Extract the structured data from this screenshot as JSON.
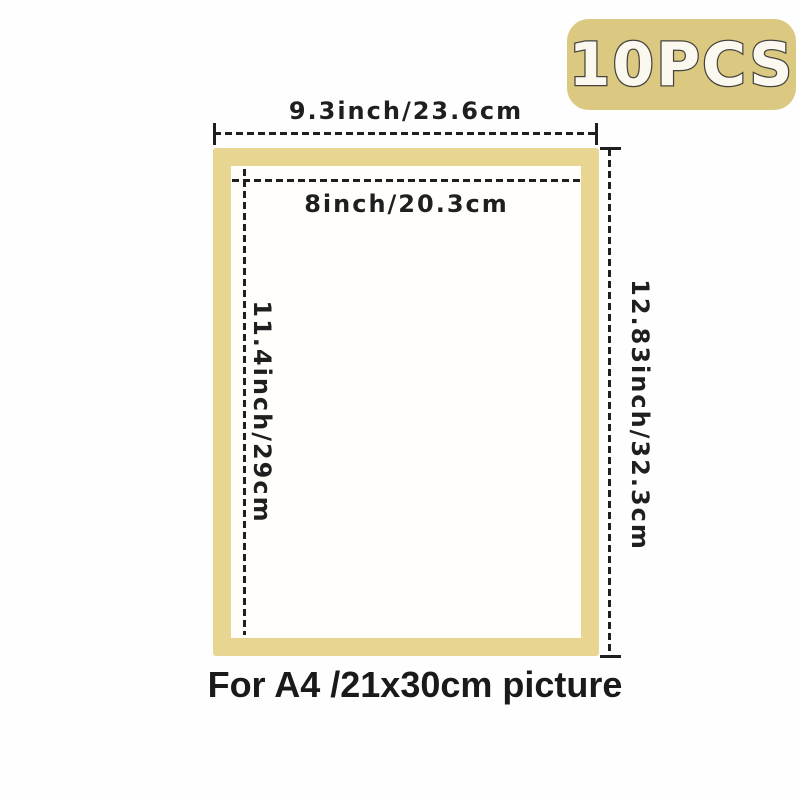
{
  "badge": {
    "label": "10PCS"
  },
  "dimensions": {
    "outer_width": {
      "label": "9.3inch/23.6cm"
    },
    "inner_width": {
      "label": "8inch/20.3cm"
    },
    "inner_height": {
      "label": "11.4inch/29cm"
    },
    "outer_height": {
      "label": "12.83inch/32.3cm"
    }
  },
  "caption": {
    "text": "For A4 /21x30cm picture"
  },
  "colors": {
    "badge_bg": "#dbc981",
    "badge_text": "#fbf8f0",
    "badge_outline": "#45433b",
    "frame_gold": "#e8d592",
    "frame_fill": "#fffefb",
    "line": "#1f1f1f",
    "background": "#fefefe"
  }
}
